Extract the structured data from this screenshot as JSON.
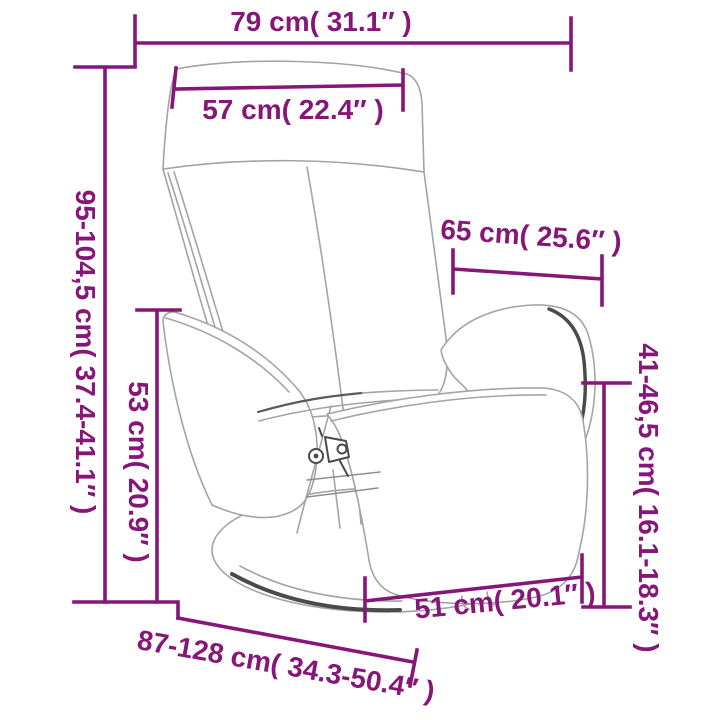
{
  "diagram": {
    "subject": "recliner-chair-with-footrest-line-drawing",
    "style": {
      "dimension_color": "#871679",
      "drawing_line_color": "#a4a4a4",
      "drawing_accent_color": "#4a4a4a",
      "background_color": "#ffffff"
    },
    "dimensions": [
      {
        "id": "total-width",
        "label": "79 cm( 31.1″ )",
        "cm": "79",
        "inches": "31.1"
      },
      {
        "id": "headrest-width",
        "label": "57 cm( 22.4″ )",
        "cm": "57",
        "inches": "22.4"
      },
      {
        "id": "total-height",
        "label": "95-104,5 cm( 37.4-41.1″ )",
        "cm": "95-104,5",
        "inches": "37.4-41.1"
      },
      {
        "id": "armrest-height",
        "label": "53 cm( 20.9″ )",
        "cm": "53",
        "inches": "20.9"
      },
      {
        "id": "seat-depth",
        "label": "65 cm( 25.6″ )",
        "cm": "65",
        "inches": "25.6"
      },
      {
        "id": "footrest-height",
        "label": "41-46,5 cm( 16.1-18.3″ )",
        "cm": "41-46,5",
        "inches": "16.1-18.3"
      },
      {
        "id": "footrest-width",
        "label": "51 cm( 20.1″ )",
        "cm": "51",
        "inches": "20.1"
      },
      {
        "id": "reclined-depth",
        "label": "87-128 cm( 34.3-50.4″ )",
        "cm": "87-128",
        "inches": "34.3-50.4"
      }
    ]
  }
}
